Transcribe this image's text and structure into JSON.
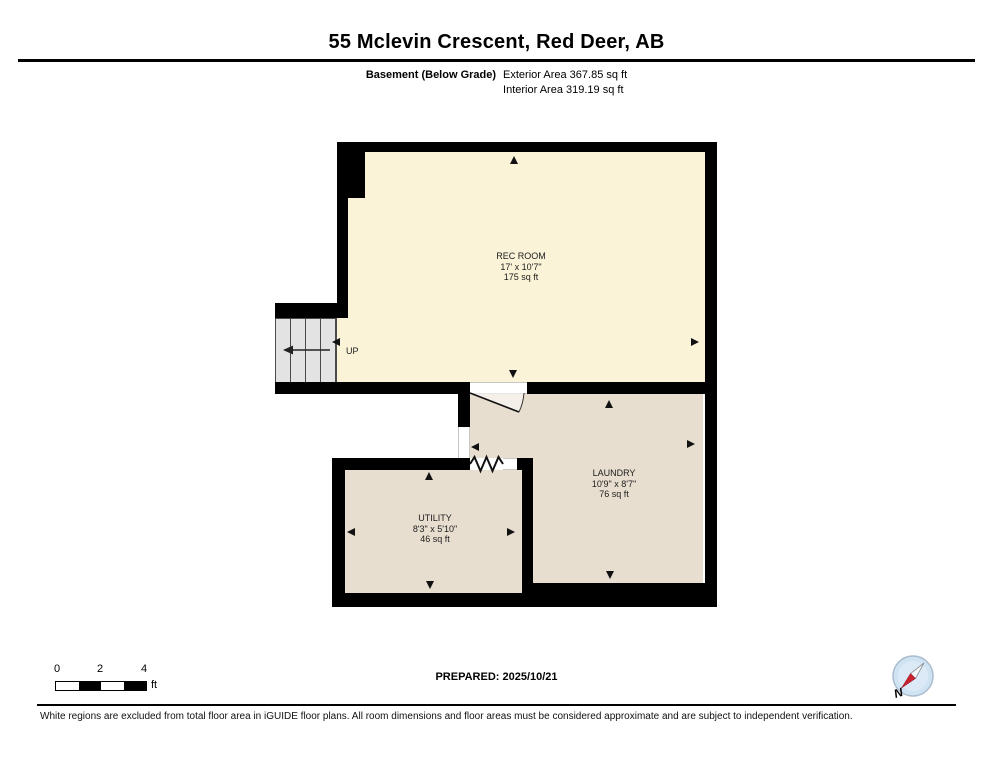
{
  "header": {
    "title": "55 Mclevin Crescent, Red Deer, AB",
    "floor_label": "Basement (Below Grade)",
    "exterior_area": "Exterior Area 367.85 sq ft",
    "interior_area": "Interior Area 319.19 sq ft"
  },
  "plan": {
    "rooms": [
      {
        "name": "REC ROOM",
        "dimensions": "17' x 10'7\"",
        "area": "175 sq ft"
      },
      {
        "name": "LAUNDRY",
        "dimensions": "10'9\" x 8'7\"",
        "area": "76 sq ft"
      },
      {
        "name": "UTILITY",
        "dimensions": "8'3\" x 5'10\"",
        "area": "46 sq ft"
      }
    ],
    "stairs_label": "UP"
  },
  "scale_bar": {
    "tick_0": "0",
    "tick_2": "2",
    "tick_4": "4",
    "unit": "ft"
  },
  "compass": {
    "label": "N"
  },
  "footer": {
    "prepared": "PREPARED: 2025/10/21",
    "disclaimer": "White regions are excluded from total floor area in iGUIDE floor plans. All room dimensions and floor areas must be considered approximate and are subject to independent verification."
  },
  "colors": {
    "wall": "#000000",
    "rec_room_fill": "#FAF3D8",
    "laundry_utility_fill": "#E7DECF",
    "stairs_fill": "#E3E3E3",
    "compass_blue": "#CFE3F3",
    "compass_needle_red": "#CC2230"
  }
}
